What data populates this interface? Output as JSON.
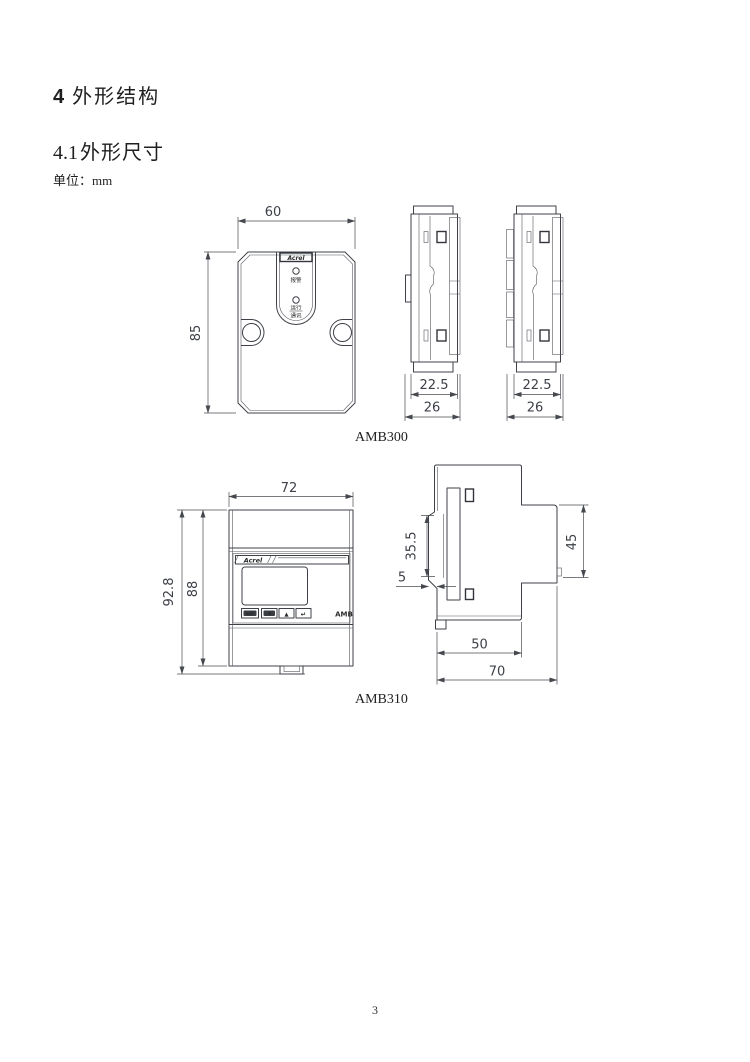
{
  "page": {
    "number": "3"
  },
  "headings": {
    "section_number": "4",
    "section_title": "外形结构",
    "subsection_number": "4.1",
    "subsection_title": "外形尺寸",
    "unit_note": "单位：mm"
  },
  "amb300": {
    "caption": "AMB300",
    "logo": "Acrel",
    "front": {
      "width": "60",
      "height": "85",
      "led_alarm": "报警",
      "led_run": "运行",
      "led_comm": "通讯"
    },
    "side": {
      "inner_width": "22.5",
      "outer_width": "26"
    }
  },
  "amb310": {
    "caption": "AMB310",
    "logo": "Acrel",
    "front": {
      "width": "72",
      "total_height": "92.8",
      "body_height": "88",
      "brand": "AMB",
      "buttons": [
        "SET",
        "◀",
        "▲",
        "↵"
      ]
    },
    "side": {
      "rail_height": "35.5",
      "clip_depth": "5",
      "panel_height": "45",
      "body_depth": "50",
      "total_depth": "70"
    }
  }
}
